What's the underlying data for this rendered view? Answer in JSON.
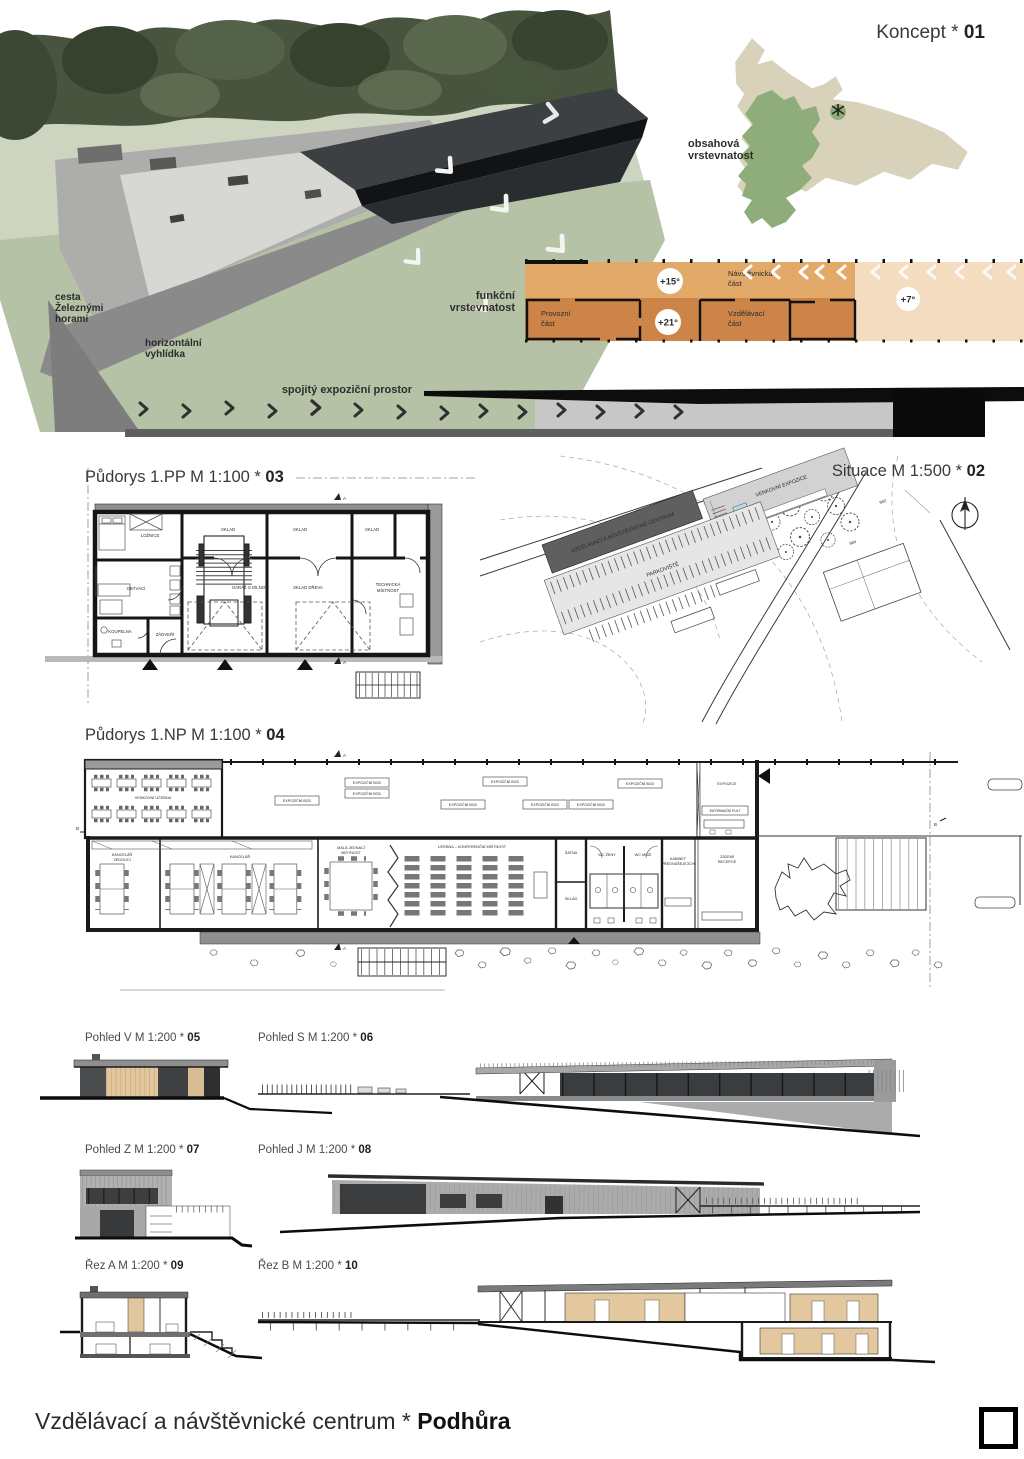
{
  "footer": {
    "title": "Vzdělávací a návštěvnické centrum * ",
    "title_bold": "Podhůra"
  },
  "titles": {
    "koncept": "Koncept * ",
    "koncept_num": "01",
    "situace": "Situace M 1:500 * ",
    "situace_num": "02",
    "pp": "Půdorys 1.PP M 1:100 * ",
    "pp_num": "03",
    "np": "Půdorys 1.NP M 1:100 * ",
    "np_num": "04",
    "pohled_v": "Pohled V M 1:200 * ",
    "pohled_v_num": "05",
    "pohled_s": "Pohled S M 1:200 * ",
    "pohled_s_num": "06",
    "pohled_z": "Pohled Z M 1:200 * ",
    "pohled_z_num": "07",
    "pohled_j": "Pohled J M 1:200 * ",
    "pohled_j_num": "08",
    "rez_a": "Řez A M 1:200 * ",
    "rez_a_num": "09",
    "rez_b": "Řez B M 1:200 * ",
    "rez_b_num": "10"
  },
  "render": {
    "road_l1": "cesta",
    "road_l2": "Železnými",
    "road_l3": "horami",
    "lookout_l1": "horizontální",
    "lookout_l2": "vyhlídka"
  },
  "koncept": {
    "map_l1": "obsahová",
    "map_l2": "vrstevnatost"
  },
  "funkcni": {
    "l1": "funkční",
    "l2": "vrstevnatost",
    "t15": "+15°",
    "t21": "+21°",
    "t7": "+7°",
    "visitor1": "Návštěvnická",
    "visitor2": "část",
    "oper1": "Provozní",
    "oper2": "část",
    "edu1": "Vzdělávací",
    "edu2": "část"
  },
  "expo": {
    "label": "spojitý expoziční prostor"
  },
  "pp": {
    "loznice": "LOŽNICE",
    "obyvaci": "OBÝVACÍ",
    "koupelna": "KOUPELNA",
    "zadveri": "ZÁDVEŘÍ",
    "garaz": "GARÁŽ S DÍLNOU",
    "sklad": "SKLAD",
    "sklad_dreva": "SKLAD DŘEVA",
    "technicka1": "TECHNICKÁ",
    "technicka2": "MÍSTNOST",
    "marker_a": "A"
  },
  "situace": {
    "budova": "VZDĚLÁVACÍ A NÁVŠTĚVNICKÉ CENTRUM",
    "venkovni": "VENKOVNÍ EXPOZICE",
    "parkoviste": "PARKOVIŠTĚ",
    "c902": "902",
    "c904": "904"
  },
  "np": {
    "terasa": "VENKOVNÍ UČEBNA",
    "expo_bod": "EXPOZIČNÍ BOD",
    "expozice": "EXPOZICE",
    "pult": "INFORMAČNÍ PULT",
    "kancelar_ved1": "KANCELÁŘ",
    "kancelar_ved2": "VEDOUCÍ",
    "kancelar": "KANCELÁŘ",
    "mala1": "MALÁ JEDNACÍ",
    "mala2": "MÍSTNOST",
    "ucebna": "UČEBNA – KONFERENČNÍ MÍSTNOST",
    "satna": "ŠATNA",
    "sklad": "SKLAD",
    "wc_zeny": "WC ŽENY",
    "wc_muzi": "WC MUŽI",
    "kabinet1": "KABINET",
    "kabinet2": "PŘEDNÁŠEJÍCÍCH",
    "zazemi1": "ZÁZEMÍ",
    "zazemi2": "RECEPCE",
    "marker_a": "A",
    "marker_b": "B"
  }
}
